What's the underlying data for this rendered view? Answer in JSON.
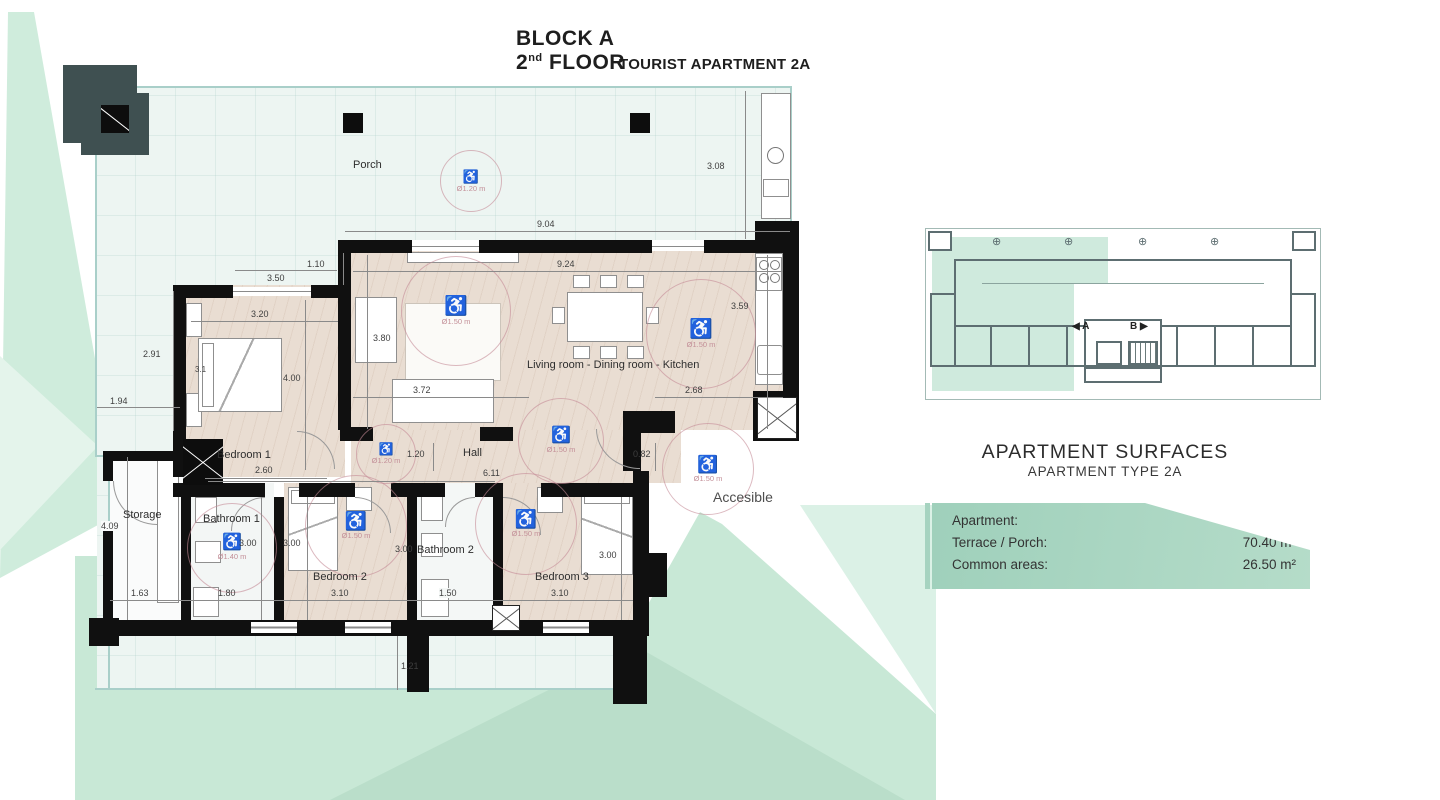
{
  "title": {
    "line1": "BLOCK A",
    "floor_num": "2",
    "floor_sup": "nd",
    "floor_rest": " FLOOR",
    "subtitle": "TOURIST APARTMENT 2A"
  },
  "plan": {
    "rooms": {
      "porch": "Porch",
      "bedroom1": "Bedroom 1",
      "living": "Living room - Dining room - Kitchen",
      "hall": "Hall",
      "storage": "Storage",
      "bathroom1": "Bathroom 1",
      "bedroom2": "Bedroom 2",
      "bathroom2": "Bathroom 2",
      "bedroom3": "Bedroom 3"
    },
    "accessible_label": "Accesible",
    "wheelchair_glyph": "♿",
    "circles": [
      {
        "id": "porch",
        "d": "Ø1.20 m"
      },
      {
        "id": "living",
        "d": "Ø1.50 m"
      },
      {
        "id": "kitchen",
        "d": "Ø1.50 m"
      },
      {
        "id": "hall",
        "d": "Ø1.50 m"
      },
      {
        "id": "hall-small",
        "d": "Ø1.20 m"
      },
      {
        "id": "bathroom1",
        "d": "Ø1.40 m"
      },
      {
        "id": "bedroom2",
        "d": "Ø1.50 m"
      },
      {
        "id": "bedroom3",
        "d": "Ø1.50 m"
      },
      {
        "id": "accessible",
        "d": "Ø1.50 m"
      }
    ],
    "dims": {
      "d350": "3.50",
      "d110": "1.10",
      "d904": "9.04",
      "d308": "3.08",
      "d924": "9.24",
      "d359": "3.59",
      "d380": "3.80",
      "d320": "3.20",
      "d291": "2.91",
      "d400": "4.00",
      "d194": "1.94",
      "d31": "3.1",
      "d260": "2.60",
      "d372": "3.72",
      "d268": "2.68",
      "d120": "1.20",
      "d611": "6.11",
      "d082": "0.82",
      "d409": "4.09",
      "d300a": "3.00",
      "d300b": "3.00",
      "d300c": "3.00",
      "d300d": "3.00",
      "d163": "1.63",
      "d180": "1.80",
      "d310a": "3.10",
      "d150": "1.50",
      "d310b": "3.10",
      "d121": "1.21"
    }
  },
  "overview": {
    "label_a": "◀ A",
    "label_b": "B ▶"
  },
  "surfaces": {
    "title": "APARTMENT SURFACES",
    "subtitle": "APARTMENT TYPE 2A",
    "rows": [
      {
        "label": "Apartment:",
        "value": "106.20 m²"
      },
      {
        "label": "Terrace / Porch:",
        "value": "70.40 m²"
      },
      {
        "label": "Common areas:",
        "value": "26.50 m²"
      }
    ]
  }
}
